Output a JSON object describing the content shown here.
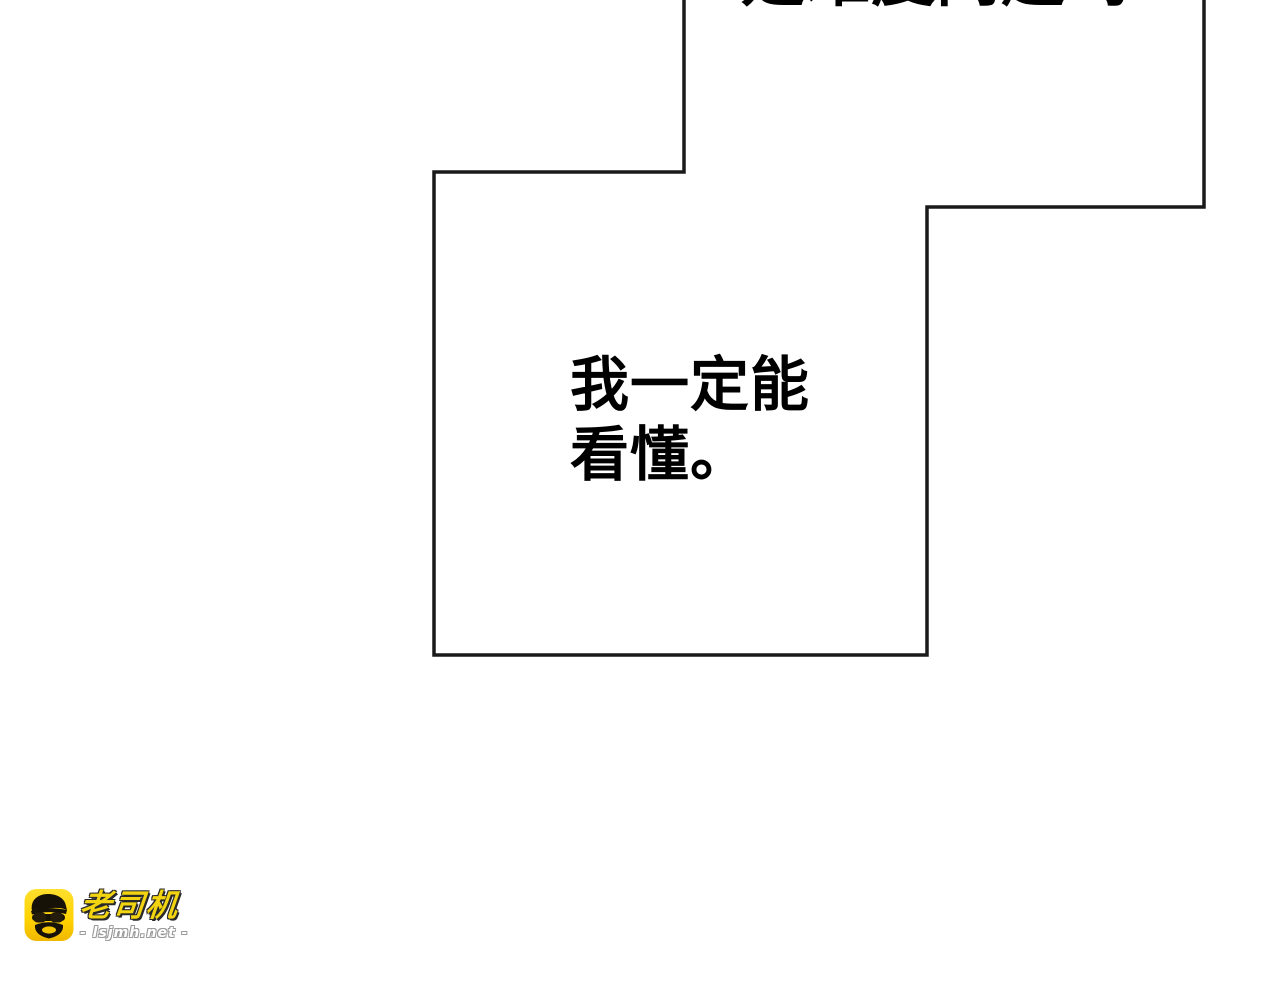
{
  "page": {
    "width": 1280,
    "height": 1000,
    "background": "#ffffff"
  },
  "bubbles": {
    "outline_color": "#1a1a1a",
    "top": {
      "partial_text": "是难度问题吗"
    },
    "main": {
      "lines": [
        "我一定能",
        "看懂。"
      ],
      "text_color": "#000000"
    }
  },
  "watermark": {
    "brand": "老司机",
    "site": "- lsjmh.net -",
    "icon": "driver-mascot-icon",
    "colors": {
      "icon_background": "#FFD200",
      "brand_text": "#F2D410",
      "outline": "#2A2A2A"
    }
  }
}
